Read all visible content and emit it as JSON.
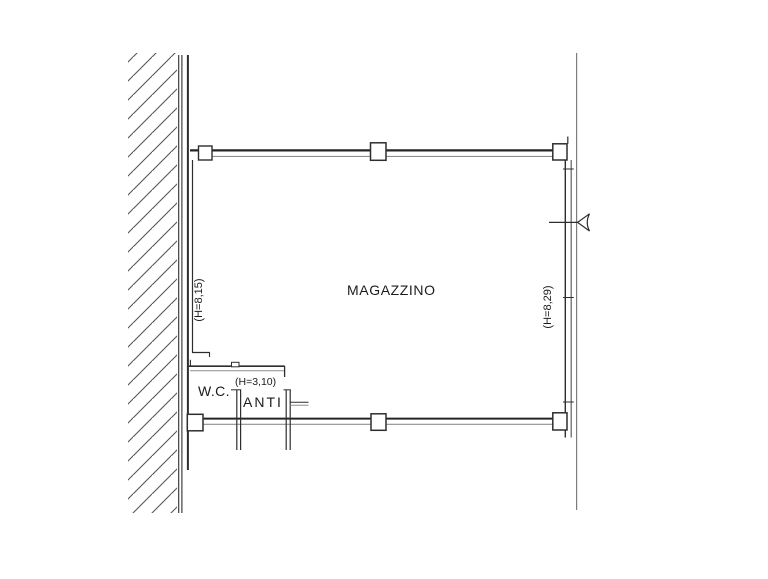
{
  "drawing": {
    "rooms": {
      "magazzino": {
        "label": "MAGAZZINO",
        "height_left": "(H=8,15)",
        "height_right": "(H=8,29)"
      },
      "wc": {
        "label": "W.C."
      },
      "anti": {
        "label": "ANTI",
        "height": "(H=3,10)"
      }
    },
    "colors": {
      "background": "#ffffff",
      "line_dark": "#2e2e2e",
      "line_light": "#8f8f8f",
      "hatch": "#565656",
      "text": "#1c1c1c"
    }
  }
}
